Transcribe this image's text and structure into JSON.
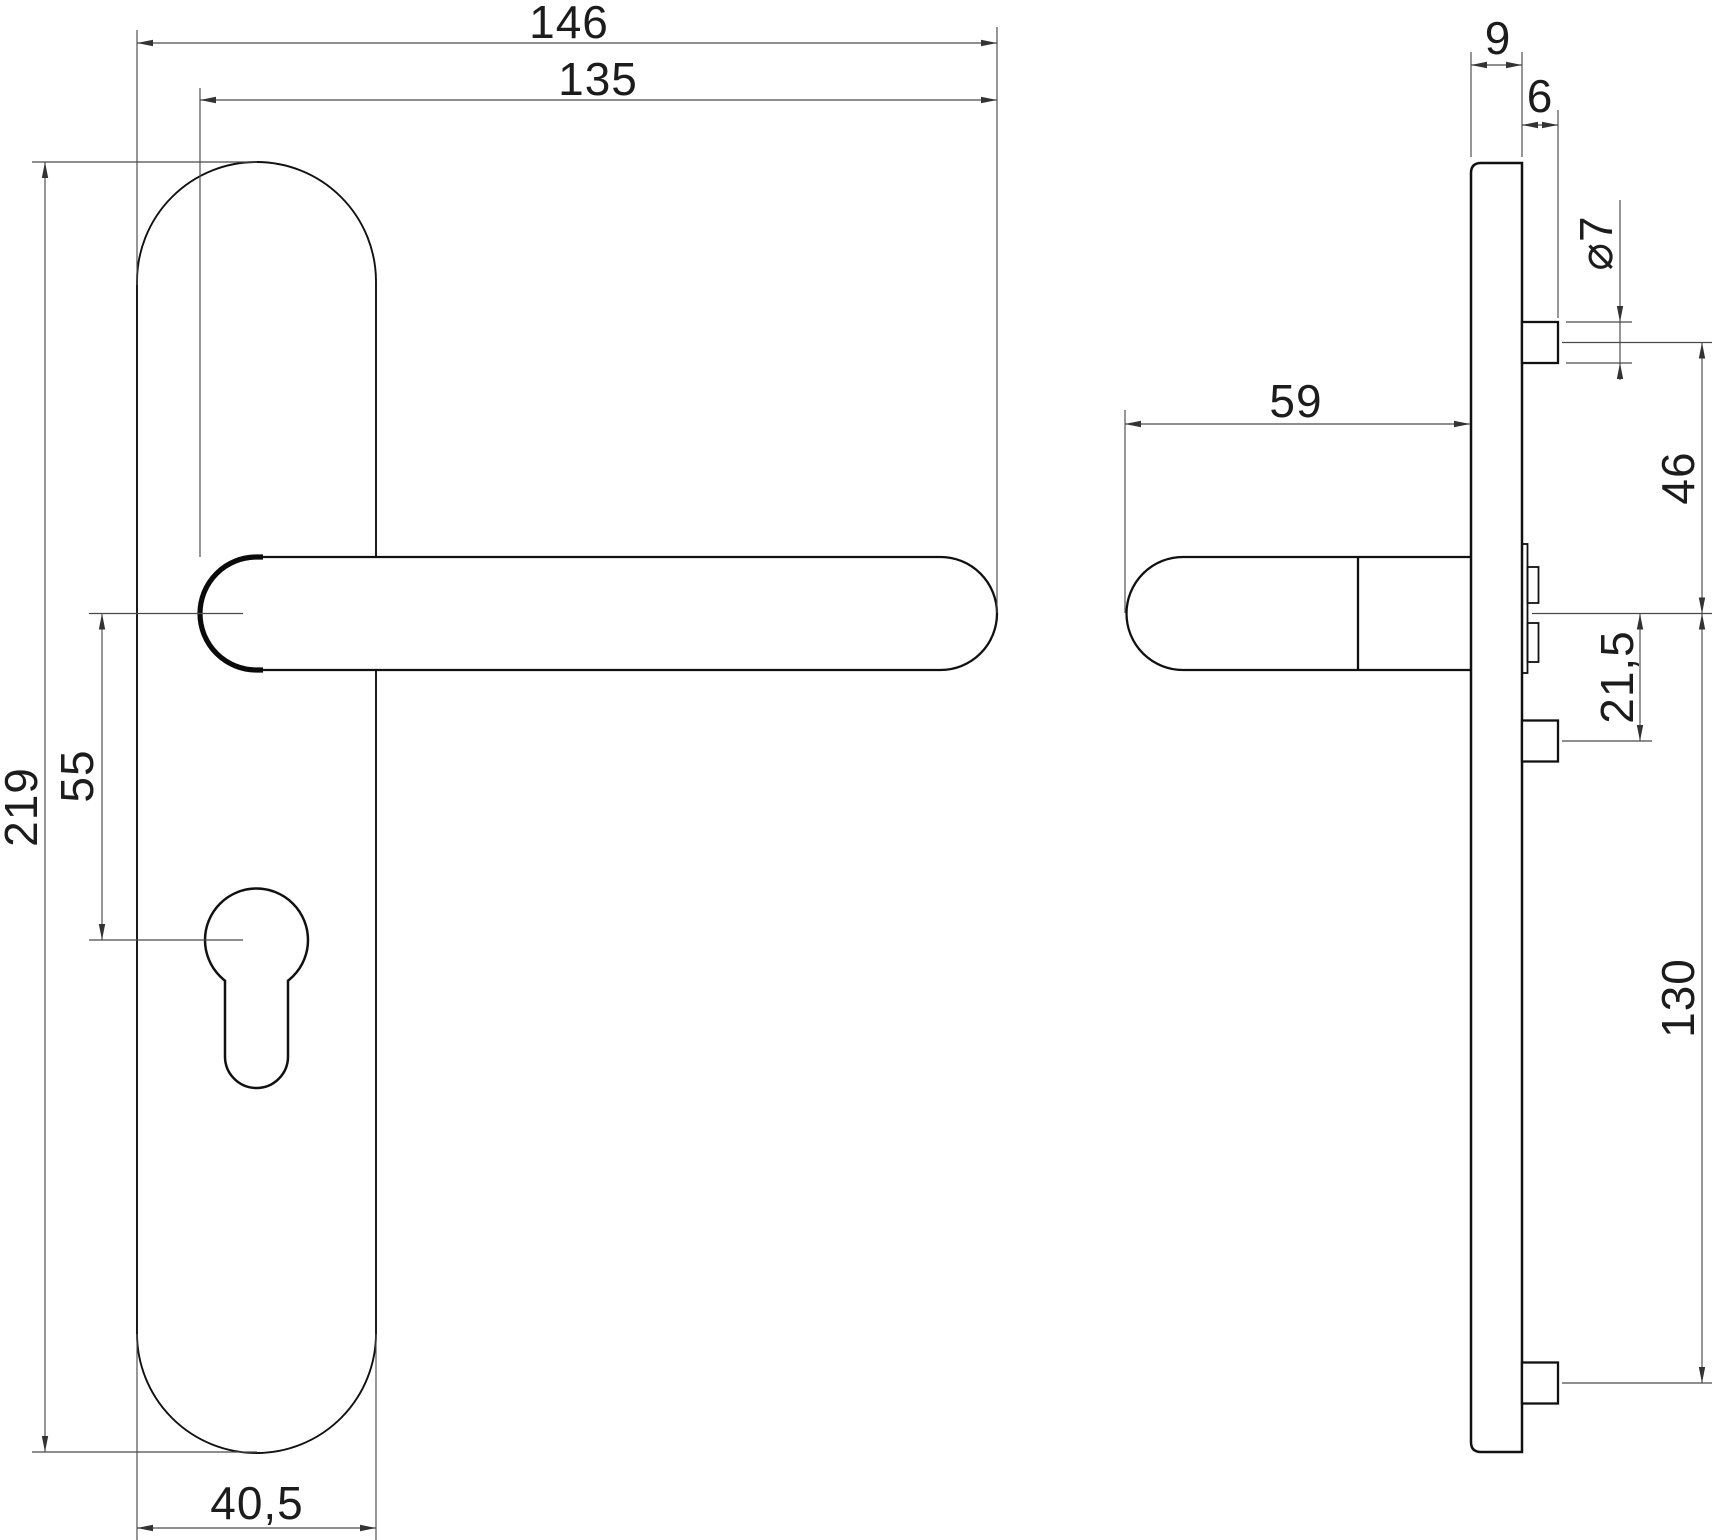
{
  "drawing": {
    "type": "technical-dimension-drawing",
    "background": "#ffffff",
    "line_color": "#111111",
    "dimension_line_color": "#4a4a4a",
    "front_view": {
      "dimensions": {
        "total_width": "146",
        "lever_length": "135",
        "plate_height": "219",
        "handle_to_cylinder": "55",
        "plate_width": "40,5"
      }
    },
    "side_view": {
      "dimensions": {
        "plate_thickness": "9",
        "bolt_protrusion": "6",
        "bolt_diameter": "⌀7",
        "handle_depth": "59",
        "top_bolt_to_centre": "46",
        "centre_to_middle_bolt": "21,5",
        "centre_to_bottom_bolt": "130"
      }
    }
  }
}
